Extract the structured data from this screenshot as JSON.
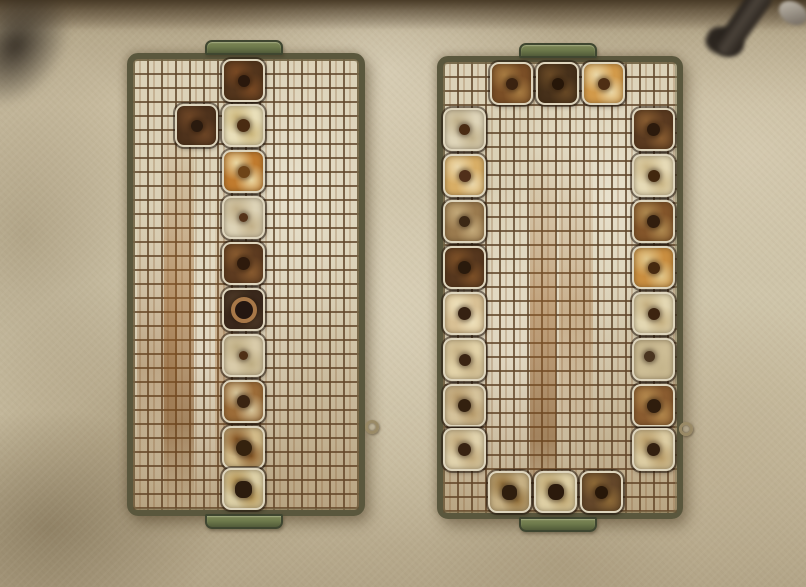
{
  "meta": {
    "type": "photograph",
    "subject": "Top-down photo of two olive-green wire-mesh trays holding small square metal tins with center holes, resting on a stained concrete floor",
    "canvas": {
      "w": 806,
      "h": 587
    }
  },
  "palette": {
    "floor-base": "#cfc5aa",
    "floor-dark": "#8d7c62",
    "top-band": "#4a3c28",
    "frame-olive": "#5a573d",
    "handle-green": "#6e7a4c",
    "handle-dark": "#3f4630",
    "wire-rust": "#60462a",
    "mesh-bed": "#d9cfb4",
    "tin-rim": "#ded5bd",
    "eyelet-metal": "#9a8a66",
    "shadow-object": "#2b251f"
  },
  "objects": {
    "top_left_shadow": {
      "label": "dark object shadow in top-left corner"
    },
    "top_right_pipe": {
      "label": "dark pipe fitting entering from top-right corner"
    },
    "floor_eyelets": [
      {
        "x": 372,
        "y": 427
      },
      {
        "x": 686,
        "y": 429
      }
    ]
  },
  "trays": [
    {
      "id": "tray-left",
      "arrangement": "single center column of 10 tins plus 1 tin offset left in row 2",
      "x": 127,
      "y": 53,
      "w": 238,
      "h": 463,
      "tins": [
        {
          "x": 89,
          "y": 0,
          "base": "#53351c",
          "mottle": "#7a4a24",
          "hole": "#2a180c",
          "hs": 12
        },
        {
          "x": 42,
          "y": 45,
          "base": "#4e321c",
          "mottle": "#6e4626",
          "hole": "#2a1a0e",
          "hs": 12
        },
        {
          "x": 89,
          "y": 45,
          "base": "#e9dfb9",
          "mottle": "#cdb87e",
          "hole": "#4a2c12",
          "hs": 13
        },
        {
          "x": 89,
          "y": 91,
          "base": "#c07b2e",
          "mottle": "#ecd9a4",
          "hole": "#6e4418",
          "hs": 12
        },
        {
          "x": 89,
          "y": 137,
          "base": "#ddd3b6",
          "mottle": "#c2b089",
          "hole": "#55331a",
          "hs": 9
        },
        {
          "x": 89,
          "y": 183,
          "base": "#5d3b20",
          "mottle": "#8a5c30",
          "hole": "#2e1a0c",
          "hs": 13
        },
        {
          "x": 89,
          "y": 229,
          "base": "#3c2a1e",
          "mottle": "#55402c",
          "hole": "#241610",
          "hs": 18,
          "ring": "#a87848"
        },
        {
          "x": 89,
          "y": 275,
          "base": "#d9cba9",
          "mottle": "#bfae84",
          "hole": "#4f2f16",
          "hs": 9
        },
        {
          "x": 89,
          "y": 321,
          "base": "#9c6c38",
          "mottle": "#d9c79c",
          "hole": "#3a2412",
          "hs": 13
        },
        {
          "x": 89,
          "y": 367,
          "base": "#d2ba88",
          "mottle": "#8a5a28",
          "hole": "#35220e",
          "hs": 16
        },
        {
          "x": 89,
          "y": 409,
          "h": 42,
          "base": "#ddd0a6",
          "mottle": "#b89858",
          "hole": "#2c1c0e",
          "hs": 17,
          "hr": 42
        }
      ]
    },
    {
      "id": "tray-right",
      "arrangement": "perimeter ring of 22 tins: 3 top, 8 left, 8 right, 3 bottom",
      "x": 437,
      "y": 56,
      "w": 246,
      "h": 463,
      "tins": [
        {
          "x": 47,
          "y": 0,
          "base": "#7a4e26",
          "mottle": "#a87c42",
          "hole": "#3a2210",
          "hs": 12
        },
        {
          "x": 93,
          "y": 0,
          "base": "#46301a",
          "mottle": "#6a4a26",
          "hole": "#261608",
          "hs": 12
        },
        {
          "x": 139,
          "y": 0,
          "base": "#d29a4a",
          "mottle": "#ecd9a8",
          "hole": "#4e2e14",
          "hs": 12
        },
        {
          "x": 0,
          "y": 46,
          "base": "#ded4b8",
          "mottle": "#c2b28c",
          "hole": "#4a2c14",
          "hs": 11
        },
        {
          "x": 0,
          "y": 92,
          "base": "#d8ae66",
          "mottle": "#ecd9ac",
          "hole": "#51301a",
          "hs": 12
        },
        {
          "x": 0,
          "y": 138,
          "base": "#9a7a4e",
          "mottle": "#c4aa7a",
          "hole": "#3c2815",
          "hs": 11
        },
        {
          "x": 0,
          "y": 184,
          "base": "#56371e",
          "mottle": "#7e5128",
          "hole": "#2a1a0c",
          "hs": 13
        },
        {
          "x": 0,
          "y": 230,
          "base": "#d8c094",
          "mottle": "#efe2bc",
          "hole": "#352112",
          "hs": 13
        },
        {
          "x": 0,
          "y": 276,
          "base": "#e2d2a8",
          "mottle": "#c9b488",
          "hole": "#3a2413",
          "hs": 12
        },
        {
          "x": 0,
          "y": 322,
          "base": "#d5c29a",
          "mottle": "#b89c6c",
          "hole": "#33200f",
          "hs": 13
        },
        {
          "x": 0,
          "y": 366,
          "base": "#e0d2ac",
          "mottle": "#c2aa7c",
          "hole": "#382312",
          "hs": 13
        },
        {
          "x": 189,
          "y": 46,
          "base": "#5a3a20",
          "mottle": "#8a5e32",
          "hole": "#2c1a0c",
          "hs": 13
        },
        {
          "x": 189,
          "y": 92,
          "base": "#e6dab6",
          "mottle": "#ccb888",
          "hole": "#42280f",
          "hs": 12
        },
        {
          "x": 189,
          "y": 138,
          "base": "#83552a",
          "mottle": "#b08a50",
          "hole": "#321e0e",
          "hs": 13
        },
        {
          "x": 189,
          "y": 184,
          "base": "#c98e40",
          "mottle": "#e2c88c",
          "hole": "#46290f",
          "hs": 12
        },
        {
          "x": 189,
          "y": 230,
          "base": "#e3d7b2",
          "mottle": "#c6b182",
          "hole": "#3c2410",
          "hs": 12
        },
        {
          "x": 189,
          "y": 276,
          "base": "#cdbd95",
          "mottle": "#c5b58c",
          "hole": "#4a3520",
          "hs": 11,
          "ox": -4,
          "oy": -3
        },
        {
          "x": 189,
          "y": 322,
          "base": "#8a5c30",
          "mottle": "#b58a4e",
          "hole": "#2f1d0d",
          "hs": 14
        },
        {
          "x": 189,
          "y": 366,
          "base": "#dccca2",
          "mottle": "#ba9e6a",
          "hole": "#332010",
          "hs": 13
        },
        {
          "x": 45,
          "y": 409,
          "h": 42,
          "base": "#c7b184",
          "mottle": "#96743e",
          "hole": "#2f1e0e",
          "hs": 15,
          "hr": 42
        },
        {
          "x": 91,
          "y": 409,
          "h": 42,
          "base": "#decfa4",
          "mottle": "#c0a873",
          "hole": "#2b1a0c",
          "hs": 16,
          "hr": 45
        },
        {
          "x": 137,
          "y": 409,
          "h": 42,
          "base": "#64472a",
          "mottle": "#8f6b38",
          "hole": "#271708",
          "hs": 13
        }
      ]
    }
  ]
}
